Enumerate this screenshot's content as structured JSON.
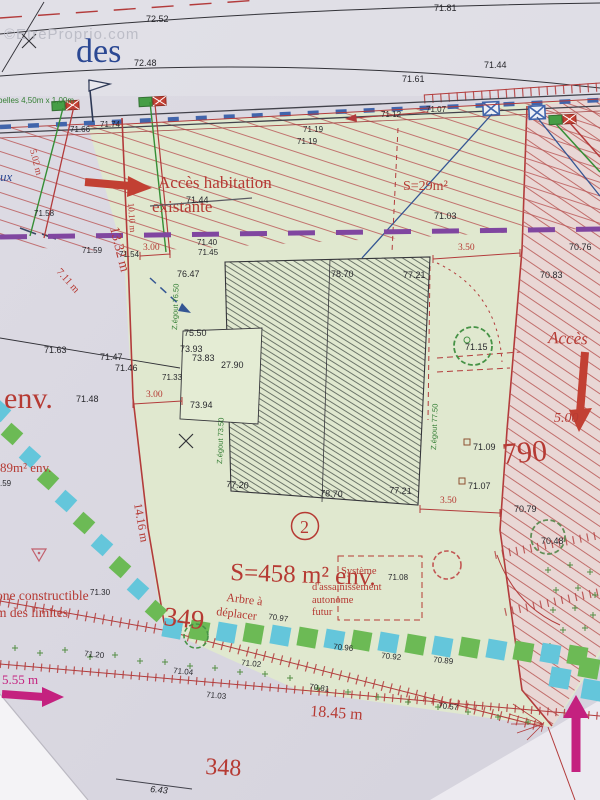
{
  "watermark": "©EtreProprio.com",
  "street": {
    "name_fragment": "des"
  },
  "top": {
    "c7252": "72.52",
    "c7181": "71.81",
    "c7248": "72.48",
    "c7161": "71.61",
    "c7144": "71.44",
    "c7112": "71.12",
    "c7107": "71.07"
  },
  "road": {
    "e7166": "71.66",
    "e7174": "71.74",
    "e7119a": "71.19",
    "e7119b": "71.19",
    "belles": "belles 4,50m x 1,00m"
  },
  "upper": {
    "acces1": "Accès habitation",
    "acces2": "existante",
    "s29": "S=29m²",
    "e7103": "71.03",
    "e7144s": "71.44",
    "e7158": "71.58",
    "eaux": "ux",
    "e7076": "70.76",
    "e7083": "70.83"
  },
  "dims": {
    "d502": "5.02 m",
    "d711": "7.11 m",
    "d1010": "10.10 m",
    "d1332": "13.32 m",
    "d300a": "3.00",
    "d300b": "3.00",
    "d350a": "3.50",
    "d350b": "3.50",
    "d1416": "14.16 m",
    "d500": "5.00",
    "d1845": "18.45 m",
    "d555": "5.55 m",
    "d643": "6.43"
  },
  "bnd": {
    "e7159": "71.59",
    "e7154": "71.54",
    "e7140": "71.40",
    "e7145": "71.45"
  },
  "bldg": {
    "e7647": "76.47",
    "e7870t": "78.70",
    "e7721t": "77.21",
    "e7550": "75.50",
    "e7393": "73.93",
    "e7383": "73.83",
    "e2790": "27.90",
    "e7394": "73.94",
    "e7133": "71.33",
    "e7720": "77.20",
    "e7870b": "78.70",
    "e7721b": "77.21",
    "zeg1": "Z.égout 76.50",
    "zeg2": "Z.égout 73.50",
    "zeg3": "Z.égout 77.50"
  },
  "left": {
    "e7163": "71.63",
    "e7147": "71.47",
    "e7146": "71.46",
    "e7148": "71.48",
    "env": "env.",
    "a89": "89m² env.",
    "p59": ".59",
    "zc1": "one constructible",
    "zc2": "m des limites",
    "e7130": "71.30"
  },
  "mid": {
    "n2": "2",
    "s458": "S=458 m² env.",
    "sys1": "Système",
    "sys2": "d'assainissement",
    "sys3": "autonome",
    "sys4": "futur",
    "e7108": "71.08",
    "n349": "349",
    "arb1": "Arbre à",
    "arb2": "déplacer",
    "e7097": "70.97",
    "e7115": "71.15"
  },
  "right": {
    "n790": "790",
    "acces": "Accès",
    "e7109": "71.09",
    "e7107": "71.07",
    "e7079": "70.79",
    "e7048": "70.48"
  },
  "bot": {
    "e7120": "71.20",
    "e7104": "71.04",
    "e7102": "71.02",
    "e7103": "71.03",
    "e7096": "70.96",
    "e7092": "70.92",
    "e7089": "70.89",
    "e7081": "70.81",
    "e7057": "70.57",
    "n348": "348"
  },
  "colors": {
    "paper": "#d8d6e0",
    "parcel_green": "#dfe8ce",
    "access_pink": "#e9d6d4",
    "accent_red": "#b3322b",
    "magenta": "#c2187a",
    "easement_purple": "#7b3f9d",
    "band_green": "#67b84f",
    "band_cyan": "#5ec4da",
    "survey_blue": "#2c4f8f"
  }
}
